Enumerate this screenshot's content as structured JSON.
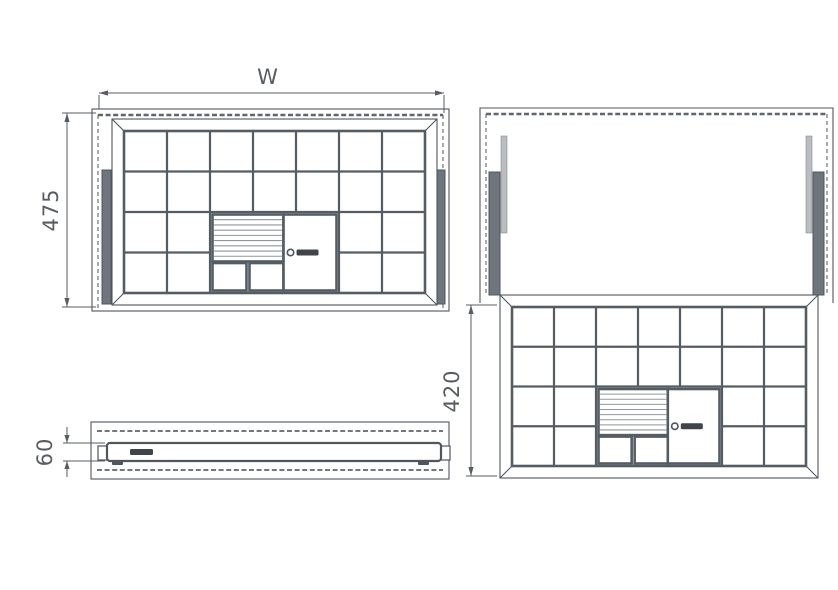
{
  "diagram": {
    "background": "#ffffff",
    "colors": {
      "line": "#4f565d",
      "grid": "#555d64",
      "stripe": "#90979d",
      "dash": "#5f666c",
      "rail": "#6f757c",
      "rod": "#b9bdc0",
      "logo": "#3f454b",
      "dim": "#575d63"
    },
    "dimensions": {
      "width": "W",
      "depth": "475",
      "front_height": "60",
      "tray_depth": "420"
    },
    "tray": {
      "columns": 7,
      "rows": 4,
      "stripe_lines": 8,
      "special": {
        "col_start": 2,
        "col_end": 5,
        "row_start": 2,
        "striped_w": 0.55,
        "striped_h": 0.58,
        "cells_y": 0.63,
        "locked_x": 0.57
      }
    },
    "icons": {
      "lock_knob_icon": "circle",
      "brand_logo": "bar"
    }
  }
}
